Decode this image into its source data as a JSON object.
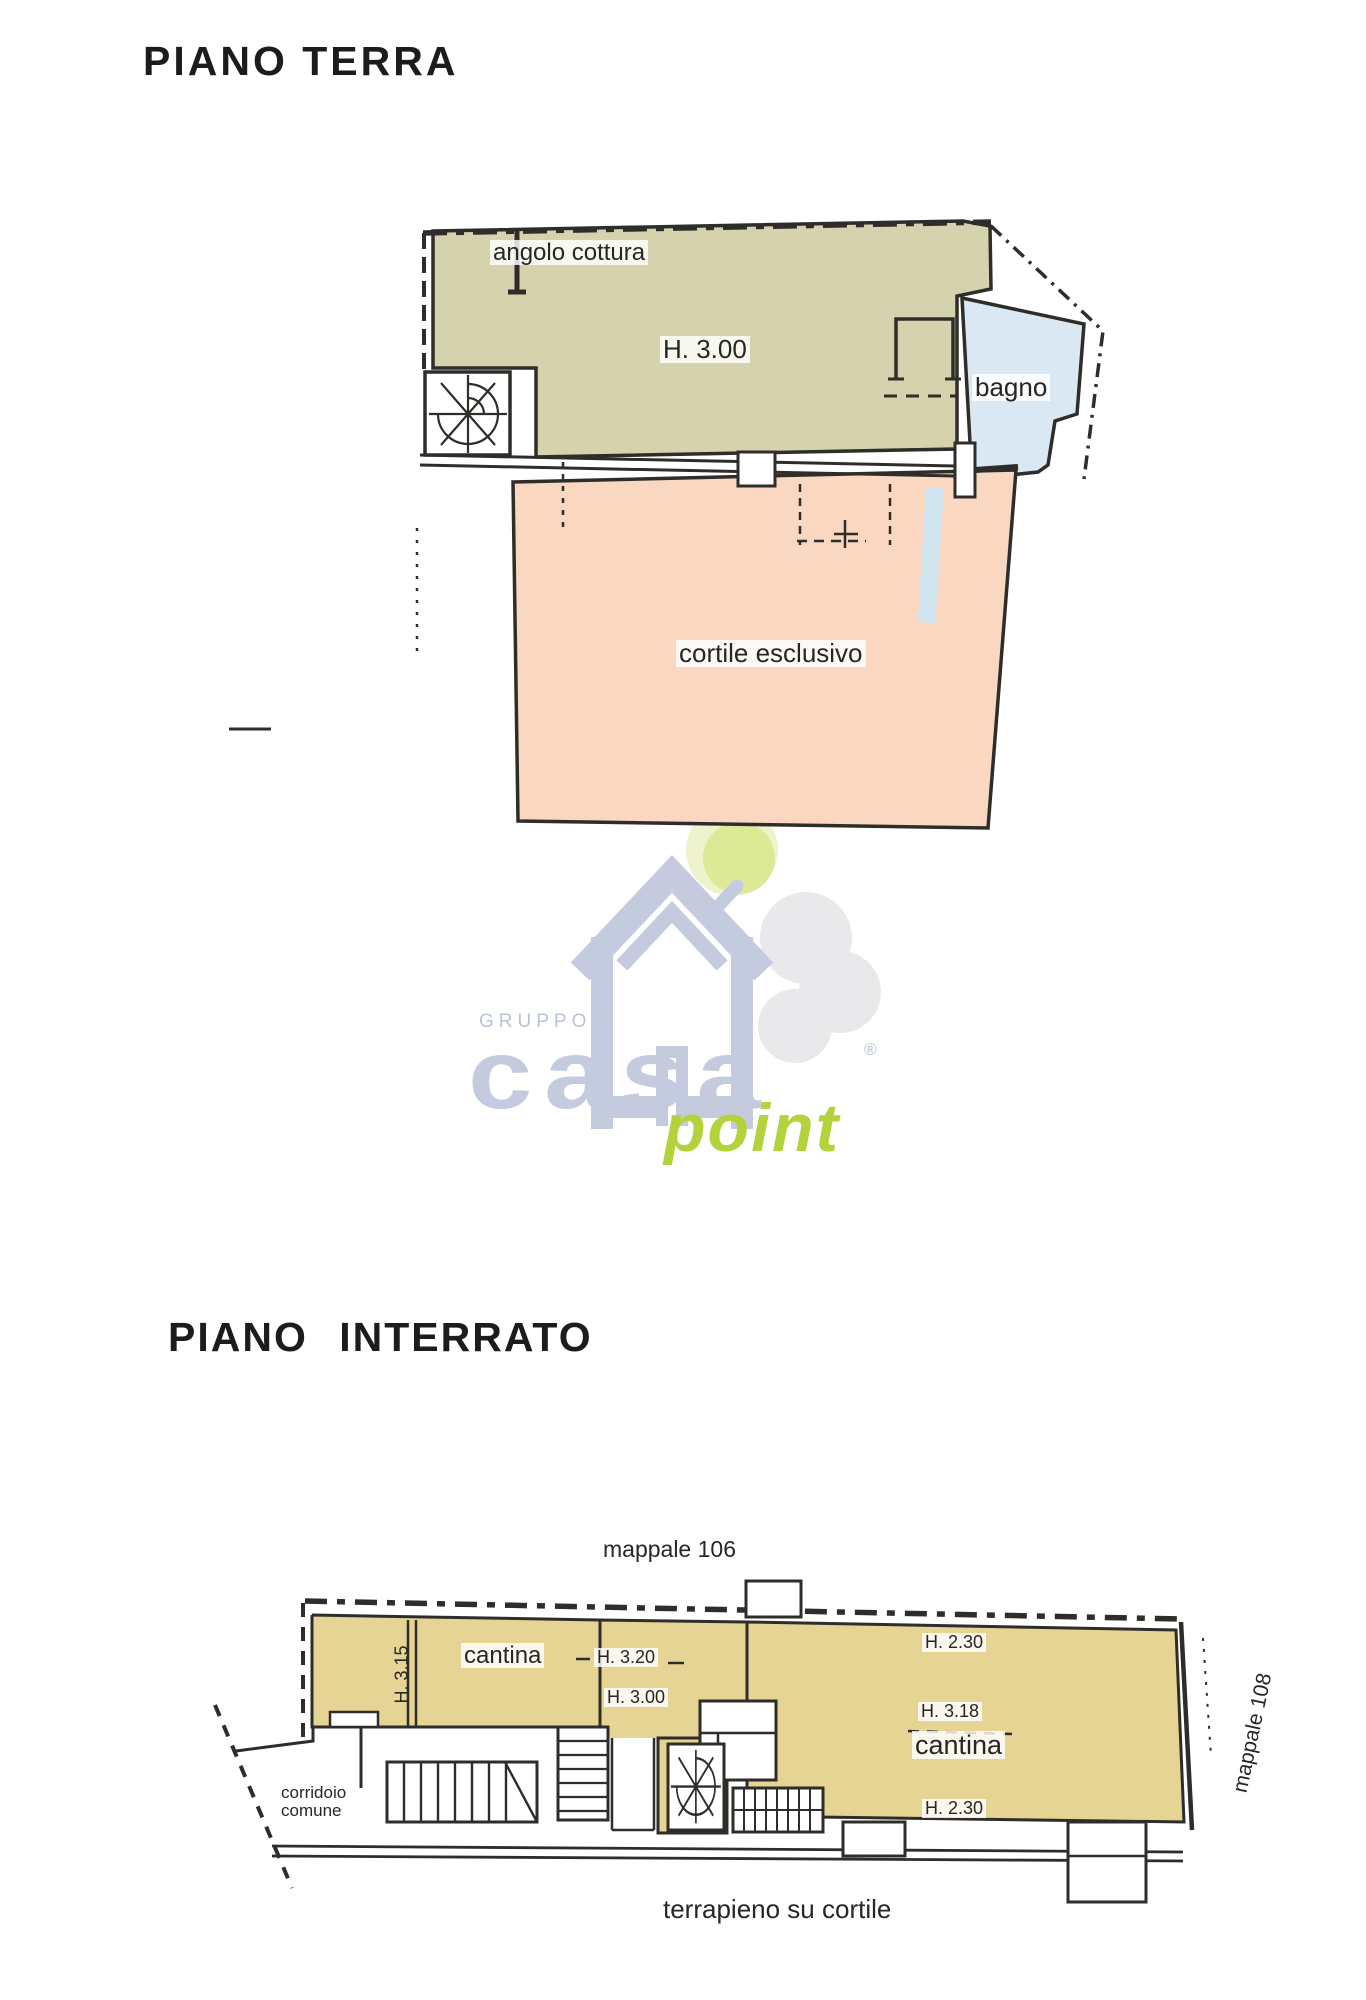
{
  "colors": {
    "room_main": "#d5d2ae",
    "room_bath": "#dae8f3",
    "courtyard": "#f9d7c1",
    "cellar": "#e6d494",
    "drain_strip": "#cfe4ef",
    "logo_blue": "#c4cbdf",
    "logo_blue_text": "#b9c2d8",
    "logo_green": "#b3d23c",
    "logo_ball": "#dcea96",
    "logo_ball_light": "#eef3cd",
    "logo_gray": "#e9e9ec",
    "white": "#ffffff"
  },
  "ground_floor": {
    "title": "PIANO TERRA",
    "kitchen_label": "angolo cottura",
    "room_height": "H. 3.00",
    "bathroom_label": "bagno",
    "courtyard_label": "cortile esclusivo"
  },
  "watermark": {
    "group": "GRUPPO",
    "brand": "casa",
    "registered": "®",
    "suffix": "point"
  },
  "basement": {
    "title": "PIANO INTERRATO",
    "parcel_above": "mappale 106",
    "parcel_right": "mappale 108",
    "cellar_left_label": "cantina",
    "cellar_left_height_side": "H. 3.15",
    "cellar_left_height_a": "H. 3.20",
    "cellar_left_height_b": "H. 3.00",
    "cellar_right_label": "cantina",
    "cellar_right_height_top": "H. 2.30",
    "cellar_right_height_mid": "H. 3.18",
    "cellar_right_height_bottom": "H. 2.30",
    "corridor_label_line1": "corridoio",
    "corridor_label_line2": "comune",
    "bottom_caption": "terrapieno su cortile"
  }
}
